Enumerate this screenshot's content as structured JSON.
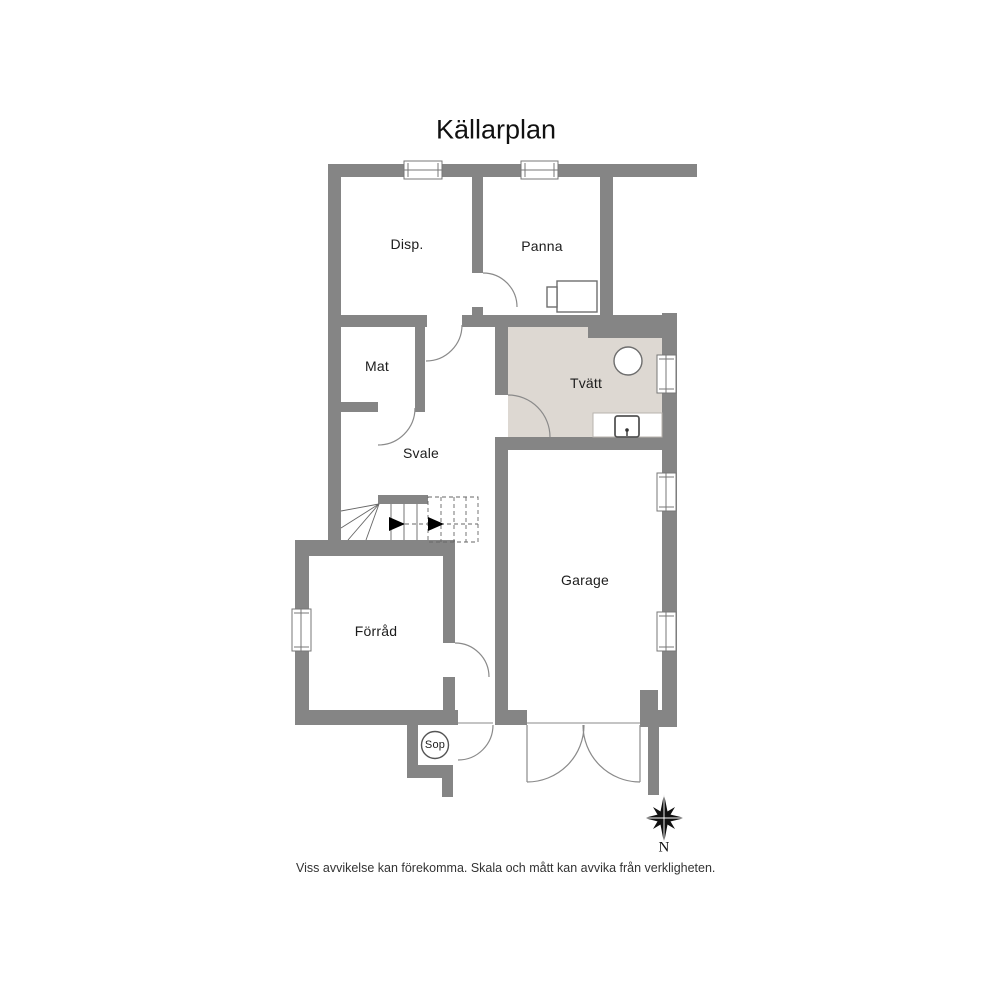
{
  "title": "Källarplan",
  "rooms": [
    {
      "id": "disp",
      "label": "Disp."
    },
    {
      "id": "panna",
      "label": "Panna"
    },
    {
      "id": "mat",
      "label": "Mat"
    },
    {
      "id": "tvatt",
      "label": "Tvätt"
    },
    {
      "id": "svale",
      "label": "Svale"
    },
    {
      "id": "forrad",
      "label": "Förråd"
    },
    {
      "id": "garage",
      "label": "Garage"
    }
  ],
  "annotations": {
    "sop": "Sop",
    "compass_north": "N"
  },
  "disclaimer": "Viss avvikelse kan förekomma. Skala och mått kan avvika från verkligheten.",
  "colors": {
    "wall": "#858585",
    "tvatt_floor": "#DDD8D2",
    "door_stroke": "#8A8A8A",
    "fixture_stroke": "#6E6E6E",
    "stair_stroke": "#666666",
    "compass": "#111111"
  }
}
